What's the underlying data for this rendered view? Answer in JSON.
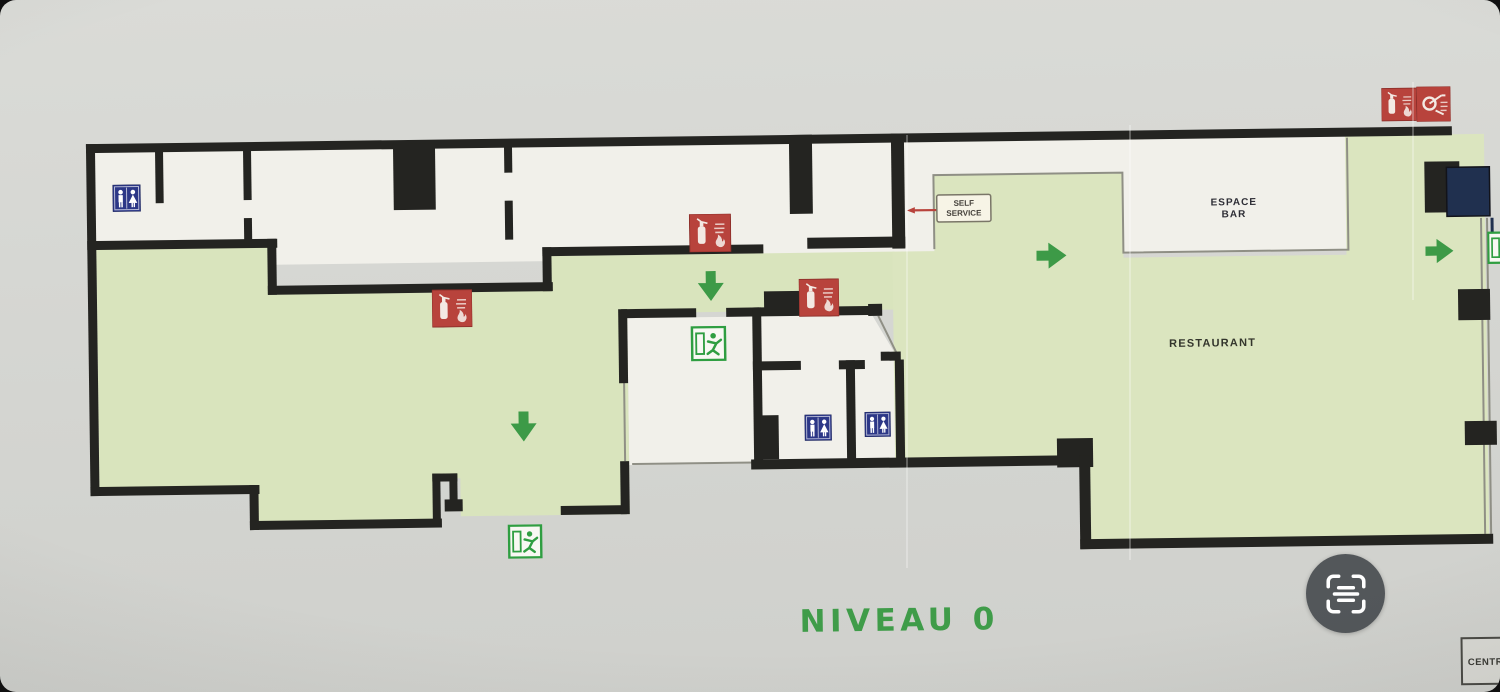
{
  "plan": {
    "title": "NIVEAU 0",
    "labels": {
      "self_service": [
        "SELF",
        "SERVICE"
      ],
      "espace_bar": [
        "ESPACE",
        "BAR"
      ],
      "restaurant": "RESTAURANT",
      "corner_box": "CENTRE"
    },
    "icons": {
      "wc": "wc-restroom-sign",
      "exit": "emergency-exit-sign",
      "extinguisher": "fire-extinguisher-sign",
      "fire_point": "fire-hose-sign",
      "arrow": "evacuation-direction-arrow"
    },
    "colors": {
      "walls": "#242421",
      "circulation_green": "#d9e4bd",
      "safety_red": "#b8433c",
      "wc_blue": "#2c3787",
      "exit_green": "#2f9e41",
      "title_green": "#3f9c49"
    }
  },
  "overlay": {
    "scan_button": "live-text-scan"
  }
}
